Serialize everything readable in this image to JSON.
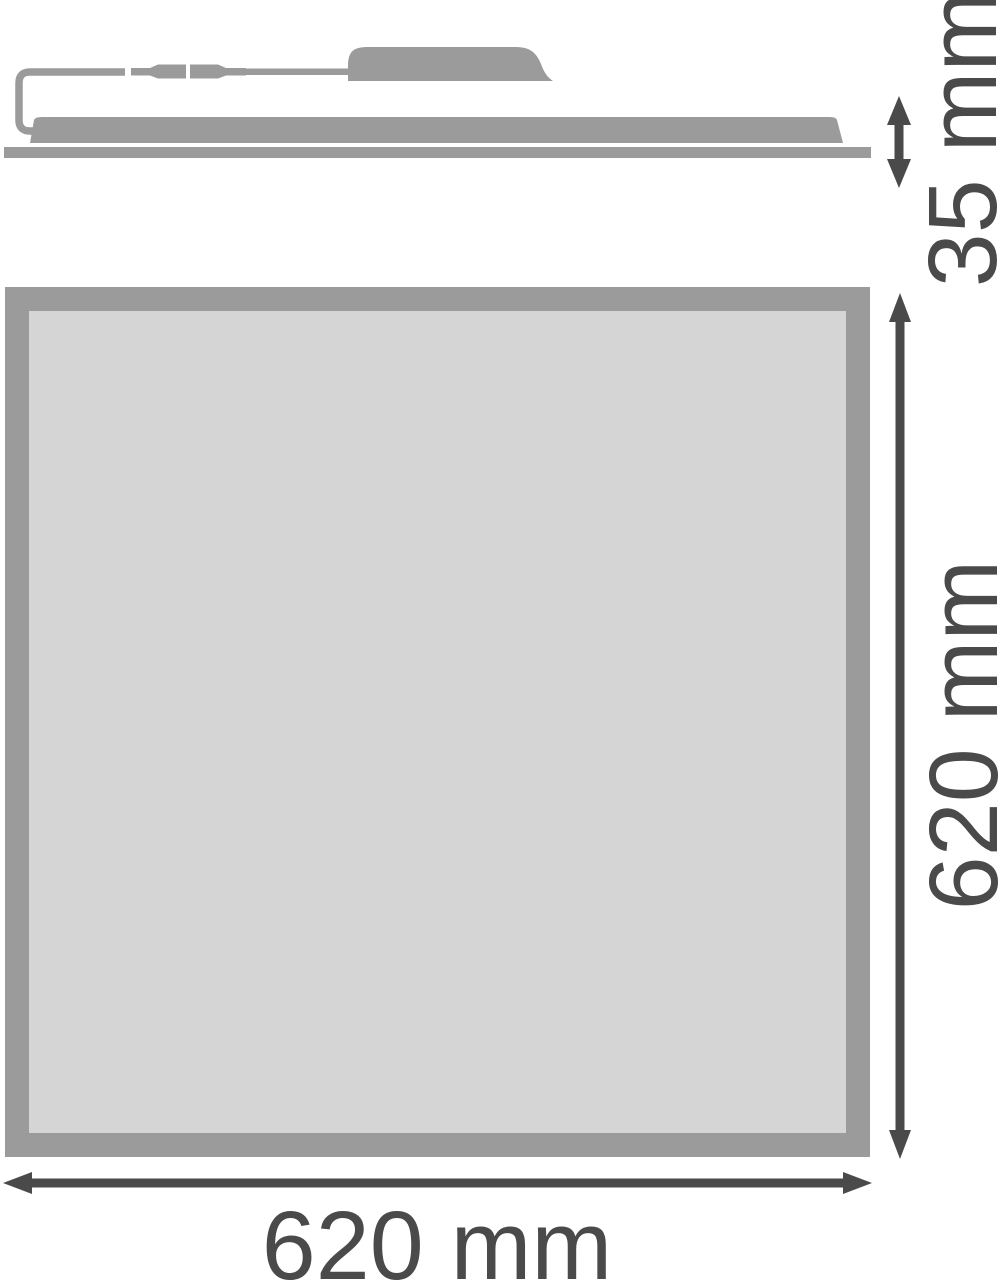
{
  "drawing": {
    "kind": "luminaire-dimension-drawing",
    "side_view": {
      "depth_label": "35 mm"
    },
    "front_view": {
      "height_label": "620 mm",
      "width_label": "620 mm"
    }
  },
  "icons": {
    "double_arrow_vertical_small": "double-headed vertical dimension arrow (35 mm)",
    "double_arrow_vertical_large": "double-headed vertical dimension arrow (620 mm)",
    "double_arrow_horizontal": "double-headed horizontal dimension arrow (620 mm)"
  },
  "colors": {
    "shape_gray": "#9b9b9b",
    "panel_face_gray": "#d5d5d5",
    "dimension_dark": "#4a4a4a",
    "background": "#ffffff"
  }
}
